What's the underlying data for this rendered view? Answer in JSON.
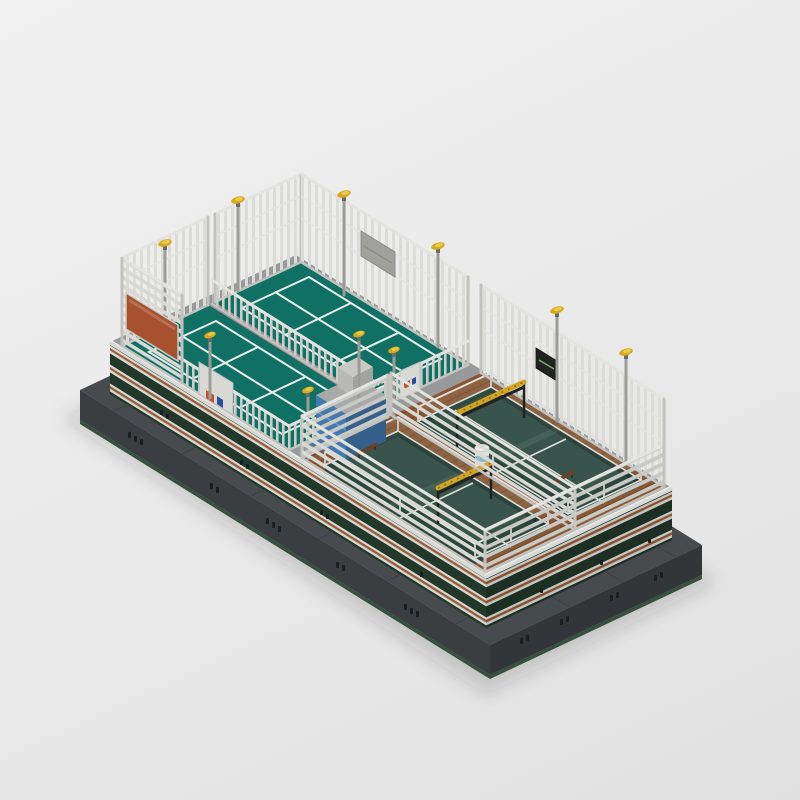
{
  "meta": {
    "domain": "natural-image",
    "kind": "3d-isometric-lego-render",
    "subject": "LEGO-style model of a fenced sports club: two raised teal tennis courts and two sunken glass courts set in brown decking, on a dark grey baseplate with striped green terrace walls, white fences and yellow floodlights",
    "background_style": "plain light-grey studio backdrop with soft ground shadow",
    "visible_text": ""
  },
  "colors": {
    "bg1": "#f1f1f1",
    "bg2": "#e9e9e9",
    "bg3": "#e1e1e1",
    "shadow": "rgba(30,32,34,0.18)",
    "plate_top": "#474b4e",
    "plate_sw": "#3a3e41",
    "plate_se": "#323639",
    "plate_trim": "#35503e",
    "vent": "#1b1e20",
    "walkway": "#97999a",
    "path_blue": "#3f6f9e",
    "court": "#117064",
    "court_dark": "#0d6158",
    "court_line": "#e9efec",
    "deck": "#8a5633",
    "plank": "rgba(40,20,8,0.28)",
    "pit": "#2b463e",
    "pit_wall": "#223b34",
    "pit_wall2": "#1d332d",
    "glass_frame": "#dfe0dc",
    "wall_green": "#223828",
    "wall_white": "#d7d8d4",
    "wall_copper": "#9c5a36",
    "wall_green_v": "#1c2f22",
    "wall_white_v": "#c4c5c1",
    "wall_copper_v": "#884e2e",
    "coping": "#d8d9d5",
    "coping_hi": "#ebebe7",
    "fence_slat": "#dbdbd7",
    "fence_slat_dim": "#cccdc9",
    "slat_u": "#d8d8d4",
    "slat_v": "#c9cac6",
    "rail_light": "#e3e3df",
    "rail_dim": "#c2c3bf",
    "pole": "#9b9c98",
    "lamp": "#d9a81f",
    "lamp_hi": "#e9cb4a",
    "lamp_mount": "#6a6a66",
    "billboard": "#a8512e",
    "kiosk": "#4479ae",
    "kiosk_dark": "#35608a",
    "kiosk_roof": "#a7aaa8",
    "box_gray": "#b9bab6",
    "box_gray_dark": "#a2a3a0",
    "sign_orange": "#c2512b",
    "sign_blue": "#2a4fa0",
    "gantry": "#d2a41f",
    "gantry_dark": "#222222",
    "scoreboard_gray": "#a0a19d",
    "scoreboard_black": "#212323",
    "bench": "#6b4226",
    "tank_body": "#dfe0dc",
    "tank_band": "#8fb8c8"
  },
  "objects": {
    "baseplate": "raised dark-grey platform with green bottom trim and black vents",
    "terrace": "elevated terrace with dark-green walls striped white and copper, white coping",
    "courts": [
      {
        "id": "court-a",
        "type": "tennis",
        "surface": "teal",
        "position": "back-left",
        "features": [
          "white playing lines",
          "tall lattice fences",
          "grey scoreboard box",
          "floodlights"
        ]
      },
      {
        "id": "court-b",
        "type": "tennis",
        "surface": "teal",
        "position": "front-left",
        "features": [
          "white playing lines",
          "tall fence with orange billboard",
          "entrance gate with orange/blue signs"
        ]
      },
      {
        "id": "court-c",
        "type": "padel",
        "surface": "dark glass-walled sunken court",
        "position": "front-right",
        "features": [
          "brown deck surround",
          "white glass frames",
          "yellow gantry",
          "bench"
        ]
      },
      {
        "id": "court-d",
        "type": "padel",
        "surface": "dark glass-walled sunken court",
        "position": "back-right",
        "features": [
          "brown deck surround",
          "white glass frames",
          "yellow gantry",
          "black scoreboard",
          "bench"
        ]
      }
    ],
    "fences": [
      "tall white vertical-slat lattice fences on back sides",
      "low white horizontal-slat fences around deck",
      "white picket railings between courts"
    ],
    "props": [
      "ten grey floodlight poles with yellow heads",
      "blue kiosk with grey rooftop unit",
      "white water tank with light-blue band",
      "two yellow gantry beams",
      "two wooden benches",
      "orange billboard",
      "two white gate signs with orange and blue panels"
    ]
  }
}
